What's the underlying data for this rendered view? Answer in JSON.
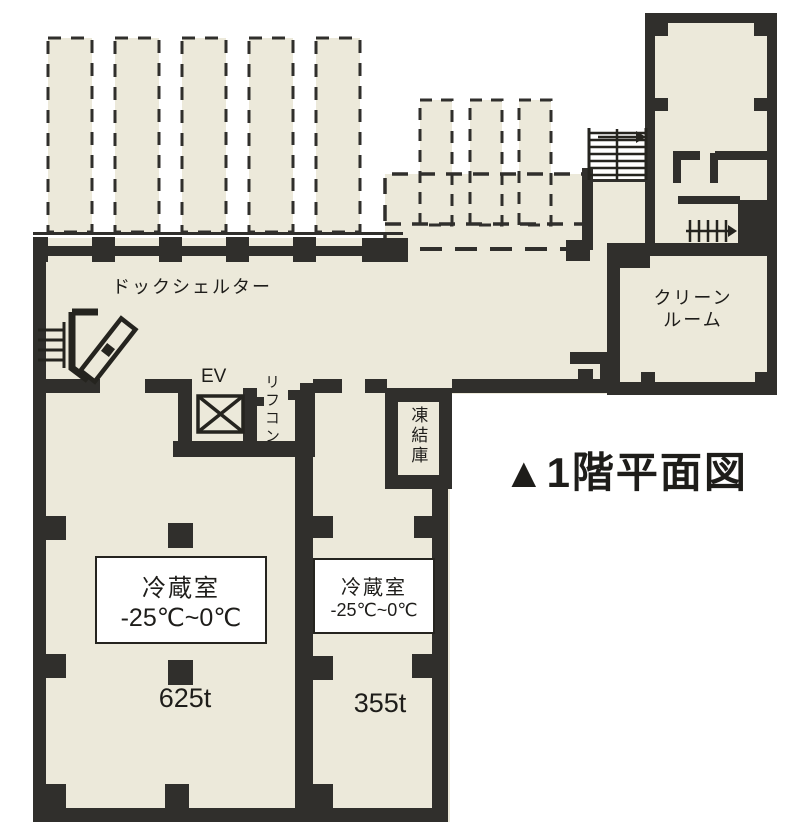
{
  "title": "▲1階平面図",
  "rooms": {
    "dock_shelter": {
      "label": "ドックシェルター"
    },
    "clean_room": {
      "label_line1": "クリーン",
      "label_line2": "ルーム"
    },
    "elevator": {
      "label": "EV"
    },
    "lift_conveyor": {
      "label": "リフコン"
    },
    "freezer": {
      "label": "凍結庫"
    },
    "cold_room_1": {
      "name": "冷蔵室",
      "temp_range": "-25℃~0℃",
      "capacity": "625t"
    },
    "cold_room_2": {
      "name": "冷蔵室",
      "temp_range": "-25℃~0℃",
      "capacity": "355t"
    }
  },
  "colors": {
    "floor": "#ECE9DA",
    "wall": "#302F2C",
    "background": "#FFFFFF",
    "label_box_border": "#25241F"
  }
}
